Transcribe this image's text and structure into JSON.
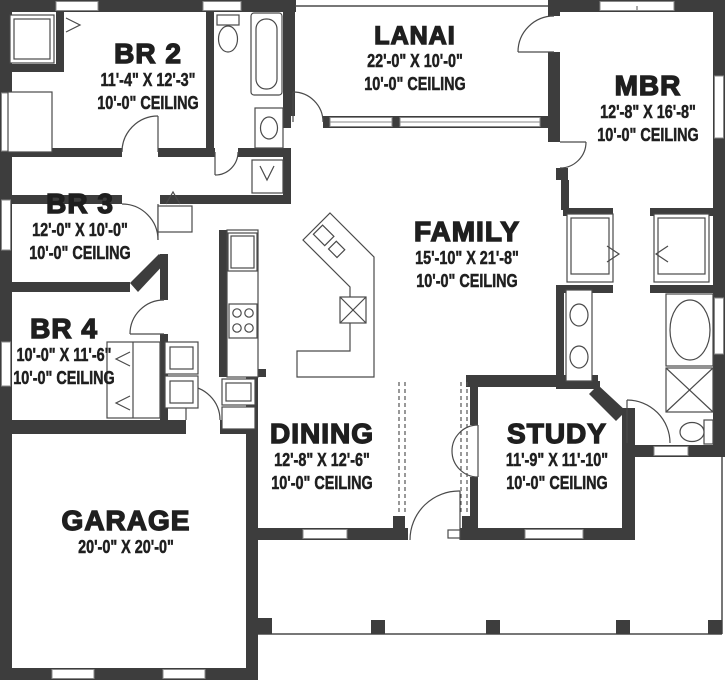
{
  "plan": {
    "title": "Single-story house floor plan",
    "rooms": [
      {
        "id": "br2",
        "name": "BR 2",
        "dim": "11'-4\" X 12'-3\"",
        "ceiling": "10'-0\" CEILING"
      },
      {
        "id": "lanai",
        "name": "LANAI",
        "dim": "22'-0\" X 10'-0\"",
        "ceiling": "10'-0\" CEILING"
      },
      {
        "id": "mbr",
        "name": "MBR",
        "dim": "12'-8\" X 16'-8\"",
        "ceiling": "10'-0\" CEILING"
      },
      {
        "id": "br3",
        "name": "BR 3",
        "dim": "12'-0\" X 10'-0\"",
        "ceiling": "10'-0\" CEILING"
      },
      {
        "id": "family",
        "name": "FAMILY",
        "dim": "15'-10\" X 21'-8\"",
        "ceiling": "10'-0\" CEILING"
      },
      {
        "id": "br4",
        "name": "BR 4",
        "dim": "10'-0\" X 11'-6\"",
        "ceiling": "10'-0\" CEILING"
      },
      {
        "id": "dining",
        "name": "DINING",
        "dim": "12'-8\" X 12'-6\"",
        "ceiling": "10'-0\" CEILING"
      },
      {
        "id": "study",
        "name": "STUDY",
        "dim": "11'-9\" X 11'-10\"",
        "ceiling": "10'-0\" CEILING"
      },
      {
        "id": "garage",
        "name": "GARAGE",
        "dim": "20'-0\" X 20'-0\"",
        "ceiling": ""
      }
    ],
    "colors": {
      "wall": "#3d3d3d",
      "line": "#4a4a4a",
      "text": "#1f1f1f",
      "bg": "#ffffff"
    }
  }
}
